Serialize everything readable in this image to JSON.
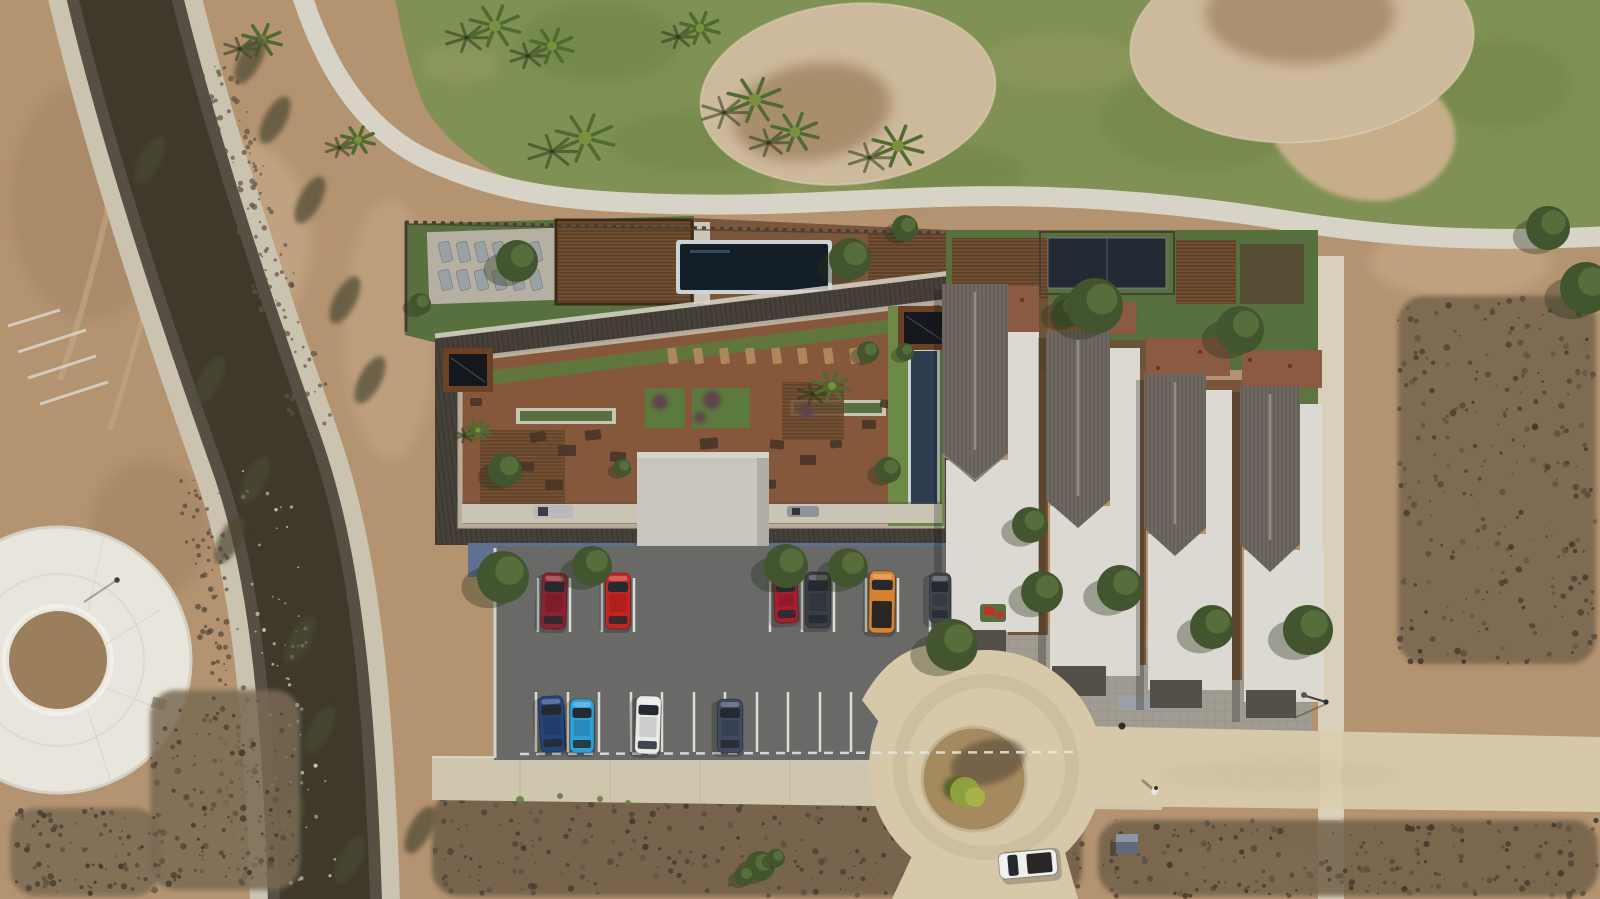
{
  "colors": {
    "dirt": "#b49371",
    "dirtLight": "#cdb28f",
    "dirtDark": "#8f7355",
    "grass": "#7f9154",
    "grassDark": "#64793f",
    "grassDry": "#a3a06b",
    "bunker": "#cdb99c",
    "bunkerCore": "#9a7c58",
    "bunkerRim": "#e4d7bb",
    "cartPath": "#d7d3c6",
    "sidePath": "#d8d0ba",
    "water": "#3e392b",
    "bankLight": "#cac3af",
    "bankDark": "#564f44",
    "sparkle": "#d8cfae",
    "bankVeg": "#4c4a32",
    "plaza": "#e8e5dc",
    "plazaEdge": "#d4d0c4",
    "plazaDirt": "#9b7e5b",
    "scrubDot": "#4b4034",
    "scrubDot2": "#5d5142",
    "scrubDot3": "#3f362c",
    "lawn": "#57703d",
    "turf": "#5d7a3e",
    "turfBright": "#6c8a46",
    "deckWood": "#85583b",
    "deckWood2": "#7a573b",
    "courtyard": "#6e5034",
    "pergola": "#5f4128",
    "pergolaSlat": "#7a5636",
    "pergolaFrame": "#3e2a18",
    "pool": "#141e26",
    "poolCoping": "#ccd3d6",
    "lapPool": "#2c3c4e",
    "court": "#232a33",
    "courtFrame": "#8a8f96",
    "roofDark": "#47413a",
    "roofRidgeLine": "#332e27",
    "roofOuterBand": "#d8d4c7",
    "panel": "#15171c",
    "panelFrame": "#6b4226",
    "walkway": "#cac4b5",
    "elevator": "#c9c6c0",
    "elevatorShade": "#b0ada7",
    "apron": "#d6d3cd",
    "facade": "#5e7190",
    "facadeSeam": "#4d5d78",
    "asphalt": "#696a67",
    "stall": "#e8e8e4",
    "curb": "#dededa",
    "townRoof": "#6f6961",
    "townRoofLine": "#4f4a44",
    "townRidge": "#9a948a",
    "townFlat": "#dcd9d2",
    "townFlatShade": "#b9b6ae",
    "canopy": "#55504a",
    "terrace": "#8a5a42",
    "paver": "#a09c92",
    "paverLine": "#8a867c",
    "road": "#d6c8a9",
    "roadPale": "#e0d5b8",
    "roadWear": "#c3b391",
    "island": "#a5895f",
    "islandShadow": "#4a3d2e",
    "bush": "#8fa03f",
    "bushLight": "#a7b24a",
    "bushDark": "#57652c",
    "treeFill": "#42552f",
    "treeLight": "#5d7440",
    "treeShadow": "#26301b",
    "palm": "#4f6b2f",
    "palmLight": "#7c8f3f",
    "palmShadow": "#2e3a1d",
    "lounger": "#9aa1a6",
    "loungerDeck": "#b6b0a2",
    "deckLounger": "#b08a5e",
    "fence": "#473f34",
    "furniture": "#4a3526",
    "shrubPurple": "#5f4050",
    "sprigGreen": "#6b7c45",
    "van": "#b9b9b9",
    "van2": "#8f949b",
    "glass": "#252a31",
    "personBody": "#e8e6e0",
    "personHead": "#3a332c",
    "utilTop": "#8b97a6",
    "utilSide": "#5f6b7a",
    "playRed": "#c03028",
    "grayCar": "#9aa0a6",
    "shadow": "#1c1a14"
  },
  "objects": {
    "cars": [
      {
        "l": "parking",
        "c": "#8c2330",
        "x": 554,
        "y": 601,
        "w": 25,
        "h": 56,
        "r": 2,
        "bed": false
      },
      {
        "l": "parking",
        "c": "#c6251f",
        "x": 618,
        "y": 601,
        "w": 25,
        "h": 56,
        "r": 0,
        "bed": false
      },
      {
        "l": "parking",
        "c": "#a81e31",
        "x": 786,
        "y": 598,
        "w": 24,
        "h": 50,
        "r": -2,
        "bed": false
      },
      {
        "l": "parking",
        "c": "#383e46",
        "x": 818,
        "y": 600,
        "w": 25,
        "h": 56,
        "r": 0,
        "bed": false
      },
      {
        "l": "parking",
        "c": "#d8822f",
        "x": 882,
        "y": 602,
        "w": 26,
        "h": 62,
        "r": 1,
        "bed": true
      },
      {
        "l": "parking",
        "c": "#3f444b",
        "x": 940,
        "y": 598,
        "w": 22,
        "h": 50,
        "r": 0,
        "bed": false
      },
      {
        "l": "parking",
        "c": "#24457c",
        "x": 552,
        "y": 724,
        "w": 25,
        "h": 56,
        "r": -3,
        "bed": false
      },
      {
        "l": "parking",
        "c": "#2da0d8",
        "x": 582,
        "y": 726,
        "w": 24,
        "h": 54,
        "r": 0,
        "bed": false
      },
      {
        "l": "parking",
        "c": "#e9e9e7",
        "x": 648,
        "y": 725,
        "w": 25,
        "h": 58,
        "r": 2,
        "bed": false
      },
      {
        "l": "parking",
        "c": "#3f4a5e",
        "x": 730,
        "y": 726,
        "w": 25,
        "h": 54,
        "r": 0,
        "bed": false
      },
      {
        "l": "road",
        "c": "#eef0ee",
        "x": 1028,
        "y": 864,
        "w": 26,
        "h": 58,
        "r": -95,
        "bed": true
      }
    ],
    "trees": [
      {
        "l": "garden",
        "x": 517,
        "y": 261,
        "r": 21
      },
      {
        "l": "garden",
        "x": 850,
        "y": 259,
        "r": 21
      },
      {
        "l": "garden",
        "x": 905,
        "y": 228,
        "r": 13
      },
      {
        "l": "garden",
        "x": 420,
        "y": 304,
        "r": 11
      },
      {
        "l": "garden",
        "x": 700,
        "y": 312,
        "r": 9
      },
      {
        "l": "deck",
        "x": 505,
        "y": 470,
        "r": 17
      },
      {
        "l": "deck",
        "x": 622,
        "y": 468,
        "r": 9
      },
      {
        "l": "deck",
        "x": 868,
        "y": 352,
        "r": 11
      },
      {
        "l": "deck",
        "x": 888,
        "y": 470,
        "r": 13
      },
      {
        "l": "deck",
        "x": 905,
        "y": 352,
        "r": 9
      },
      {
        "l": "parking",
        "x": 503,
        "y": 577,
        "r": 26
      },
      {
        "l": "parking",
        "x": 592,
        "y": 566,
        "r": 20
      },
      {
        "l": "parking",
        "x": 786,
        "y": 566,
        "r": 22
      },
      {
        "l": "parking",
        "x": 848,
        "y": 568,
        "r": 20
      },
      {
        "l": "parking",
        "x": 952,
        "y": 645,
        "r": 26
      },
      {
        "l": "town",
        "x": 1030,
        "y": 525,
        "r": 18
      },
      {
        "l": "town",
        "x": 1042,
        "y": 592,
        "r": 21
      },
      {
        "l": "town",
        "x": 1120,
        "y": 588,
        "r": 23
      },
      {
        "l": "town",
        "x": 1212,
        "y": 627,
        "r": 22
      },
      {
        "l": "town",
        "x": 1308,
        "y": 630,
        "r": 25
      },
      {
        "l": "town",
        "x": 1068,
        "y": 310,
        "r": 17
      },
      {
        "l": "town",
        "x": 1095,
        "y": 306,
        "r": 28
      },
      {
        "l": "town",
        "x": 1240,
        "y": 330,
        "r": 24
      },
      {
        "l": "misc",
        "x": 1548,
        "y": 228,
        "r": 22
      },
      {
        "l": "misc",
        "x": 1586,
        "y": 288,
        "r": 26
      },
      {
        "l": "misc",
        "x": 760,
        "y": 866,
        "r": 15
      },
      {
        "l": "misc",
        "x": 744,
        "y": 876,
        "r": 10
      },
      {
        "l": "misc",
        "x": 776,
        "y": 858,
        "r": 9
      }
    ],
    "palms": [
      {
        "l": "golf",
        "x": 262,
        "y": 40,
        "s": 20
      },
      {
        "l": "golf",
        "x": 358,
        "y": 140,
        "s": 17
      },
      {
        "l": "golf",
        "x": 495,
        "y": 26,
        "s": 26
      },
      {
        "l": "golf",
        "x": 552,
        "y": 46,
        "s": 22
      },
      {
        "l": "golf",
        "x": 585,
        "y": 138,
        "s": 30
      },
      {
        "l": "golf",
        "x": 700,
        "y": 28,
        "s": 20
      },
      {
        "l": "golf",
        "x": 755,
        "y": 100,
        "s": 28
      },
      {
        "l": "golf",
        "x": 795,
        "y": 132,
        "s": 24
      },
      {
        "l": "golf",
        "x": 898,
        "y": 146,
        "s": 26
      },
      {
        "l": "deck",
        "x": 478,
        "y": 430,
        "s": 12
      },
      {
        "l": "deck",
        "x": 832,
        "y": 386,
        "s": 18
      }
    ],
    "furniture": [
      {
        "x": 530,
        "y": 432,
        "w": 16,
        "h": 10,
        "r": -8
      },
      {
        "x": 558,
        "y": 445,
        "w": 18,
        "h": 11,
        "r": 0
      },
      {
        "x": 520,
        "y": 462,
        "w": 14,
        "h": 9,
        "r": 5
      },
      {
        "x": 585,
        "y": 430,
        "w": 16,
        "h": 10,
        "r": -6
      },
      {
        "x": 470,
        "y": 398,
        "w": 12,
        "h": 8,
        "r": 0
      },
      {
        "x": 610,
        "y": 452,
        "w": 16,
        "h": 10,
        "r": 4
      },
      {
        "x": 700,
        "y": 438,
        "w": 18,
        "h": 11,
        "r": -5
      },
      {
        "x": 735,
        "y": 452,
        "w": 16,
        "h": 10,
        "r": 0
      },
      {
        "x": 770,
        "y": 440,
        "w": 14,
        "h": 9,
        "r": 6
      },
      {
        "x": 800,
        "y": 455,
        "w": 16,
        "h": 10,
        "r": 0
      },
      {
        "x": 830,
        "y": 440,
        "w": 12,
        "h": 8,
        "r": -6
      },
      {
        "x": 862,
        "y": 420,
        "w": 14,
        "h": 9,
        "r": 0
      },
      {
        "x": 880,
        "y": 400,
        "w": 12,
        "h": 8,
        "r": 8
      },
      {
        "x": 545,
        "y": 480,
        "w": 18,
        "h": 10,
        "r": 0
      },
      {
        "x": 760,
        "y": 480,
        "w": 16,
        "h": 9,
        "r": -4
      }
    ],
    "deckLoungerXs": [
      668,
      694,
      720,
      746,
      772,
      798,
      824,
      850
    ],
    "gardenLoungers": {
      "xs": [
        440,
        458,
        476,
        494,
        512,
        530
      ],
      "rows": [
        242,
        270
      ]
    },
    "shrubsPurple": [
      {
        "x": 660,
        "y": 402,
        "r": 8
      },
      {
        "x": 712,
        "y": 400,
        "r": 9
      },
      {
        "x": 700,
        "y": 418,
        "r": 6
      },
      {
        "x": 806,
        "y": 412,
        "r": 7
      }
    ],
    "sprigs": [
      {
        "x": 520,
        "y": 800,
        "r": 4
      },
      {
        "x": 560,
        "y": 796,
        "r": 3
      },
      {
        "x": 600,
        "y": 799,
        "r": 3
      },
      {
        "x": 628,
        "y": 803,
        "r": 3
      }
    ],
    "terraceDots": [
      {
        "x": 1158,
        "y": 368
      },
      {
        "x": 1200,
        "y": 352
      },
      {
        "x": 1250,
        "y": 360
      },
      {
        "x": 1290,
        "y": 366
      },
      {
        "x": 1022,
        "y": 300
      }
    ],
    "stalls": {
      "topXs": [
        538,
        570,
        602,
        634,
        770,
        802,
        834,
        866,
        898,
        930
      ],
      "topY1": 578,
      "topY2": 632,
      "bottomXs": [
        536,
        568,
        599,
        631,
        662,
        694,
        725,
        757,
        788,
        820,
        851,
        883,
        914,
        946,
        977,
        1009,
        1040,
        1067
      ],
      "bottomY1": 692,
      "bottomY2": 752
    },
    "sparkles": {
      "count": 60,
      "seed": 11
    },
    "bankDots": {
      "right": 130,
      "left": 110,
      "seed": 5
    },
    "scrubRegions": [
      {
        "x": 1398,
        "y": 296,
        "w": 198,
        "h": 368,
        "n": 260,
        "base": "#76654e"
      },
      {
        "x": 432,
        "y": 792,
        "w": 650,
        "h": 104,
        "n": 300,
        "base": "#6e5c47"
      },
      {
        "x": 1098,
        "y": 820,
        "w": 500,
        "h": 76,
        "n": 200,
        "base": "#71604a"
      },
      {
        "x": 1096,
        "y": 688,
        "w": 205,
        "h": 42,
        "n": 90,
        "base": "#6f5e49"
      },
      {
        "x": 150,
        "y": 690,
        "w": 150,
        "h": 200,
        "n": 130,
        "base": "#7a6a52"
      },
      {
        "x": 10,
        "y": 808,
        "w": 150,
        "h": 88,
        "n": 90,
        "base": "#7a6a52"
      }
    ]
  }
}
